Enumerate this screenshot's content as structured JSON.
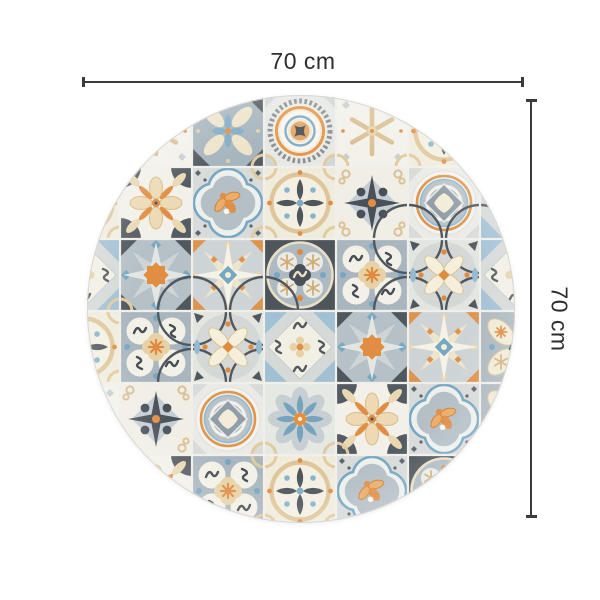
{
  "page": {
    "background_color": "#ffffff"
  },
  "product": {
    "type": "round vinyl rug",
    "pattern": "azulejo hydraulic-tile patchwork",
    "shape": "circle"
  },
  "dimensions": {
    "top": {
      "label": "70 cm"
    },
    "right": {
      "label": "70 cm"
    },
    "line_color": "#3b3b3b",
    "label_color": "#2e2e2e"
  },
  "mat": {
    "edge_color": "#d8d8d4",
    "grout_color": "#f0efe9",
    "palette": {
      "charcoal": "#474e55",
      "slate_gray": "#8d99a3",
      "blue_gray": "#a6b3bc",
      "light_gray": "#d6dad9",
      "off_white": "#f3f1e9",
      "cream": "#f0e9d4",
      "beige": "#e2cda2",
      "orange": "#e0883a",
      "steel_blue": "#6fa3c0",
      "light_blue": "#9dbdd2"
    },
    "grid": {
      "tile_size": 72,
      "origin_x": 48,
      "origin_y": 95,
      "rows": [
        [
          "ovalLeaf",
          "snowflake",
          "petalGray",
          "medallionBowtie",
          "snowflake",
          "ringFleur",
          "ovalLeaf"
        ],
        [
          "ringFleur",
          "petalOrange",
          "quatrefoilBee",
          "ringFleur",
          "crossStar",
          "medallionDiamond",
          "diamondOrnate"
        ],
        [
          "diamondOrnate",
          "star8orange",
          "star8cream",
          "ringDark",
          "clover",
          "arcFlower",
          "diamondOrnate"
        ],
        [
          "ringFleur",
          "clover",
          "arcFlower",
          "diamondOrnate",
          "star8orange",
          "star8cream",
          "ovalLeaf"
        ],
        [
          "snowflake",
          "crossStar",
          "medallionDiamond",
          "flowerBlue",
          "petalOrange",
          "quatrefoilBee",
          "ovalLeaf"
        ],
        [
          "ovalLeaf",
          "petalOrange",
          "clover",
          "ringFleur",
          "quatrefoilBee",
          "ringDark",
          "ovalLeaf"
        ]
      ]
    }
  }
}
